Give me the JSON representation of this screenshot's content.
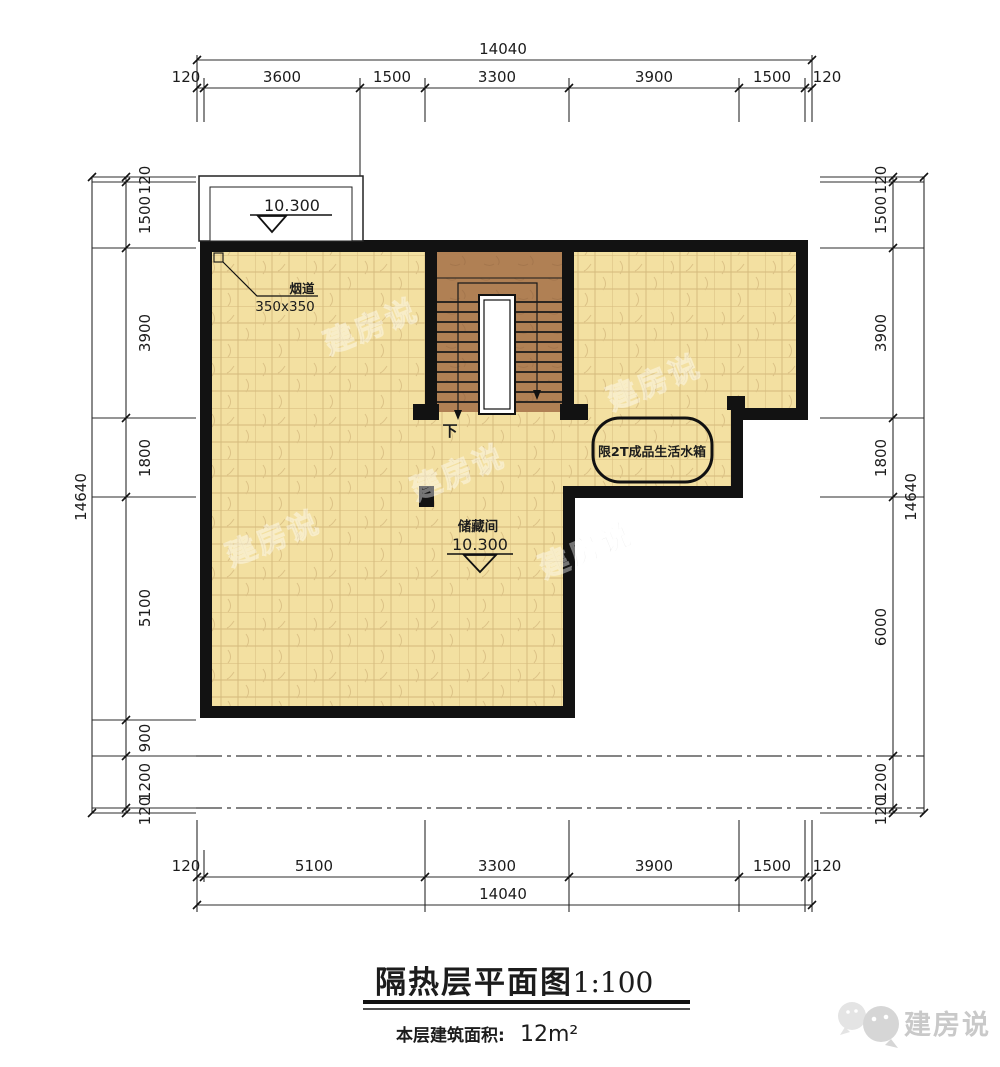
{
  "drawing": {
    "title": "隔热层平面图",
    "scale": "1:100",
    "area_label": "本层建筑面积:",
    "area_value": "12m²"
  },
  "logo": {
    "name": "建房说"
  },
  "watermark": {
    "text": "建房说"
  },
  "plan": {
    "room_label": "储藏间",
    "room_level": "10.300",
    "balcony_level": "10.300",
    "flue_label": "烟道",
    "flue_size": "350x350",
    "water_tank_label": "限2T成品生活水箱",
    "stair_direction": "下"
  },
  "dimensions": {
    "top": {
      "overall": "14040",
      "segments": [
        "120",
        "3600",
        "1500",
        "3300",
        "3900",
        "1500",
        "120"
      ]
    },
    "bottom": {
      "overall": "14040",
      "segments": [
        "120",
        "5100",
        "3300",
        "3900",
        "1500",
        "120"
      ]
    },
    "left": {
      "overall": "14640",
      "segments": [
        "120",
        "1500",
        "3900",
        "1800",
        "5100",
        "900",
        "1200",
        "120"
      ]
    },
    "right": {
      "overall": "14640",
      "segments": [
        "120",
        "1500",
        "3900",
        "1800",
        "6000",
        "1200",
        "120"
      ]
    }
  }
}
